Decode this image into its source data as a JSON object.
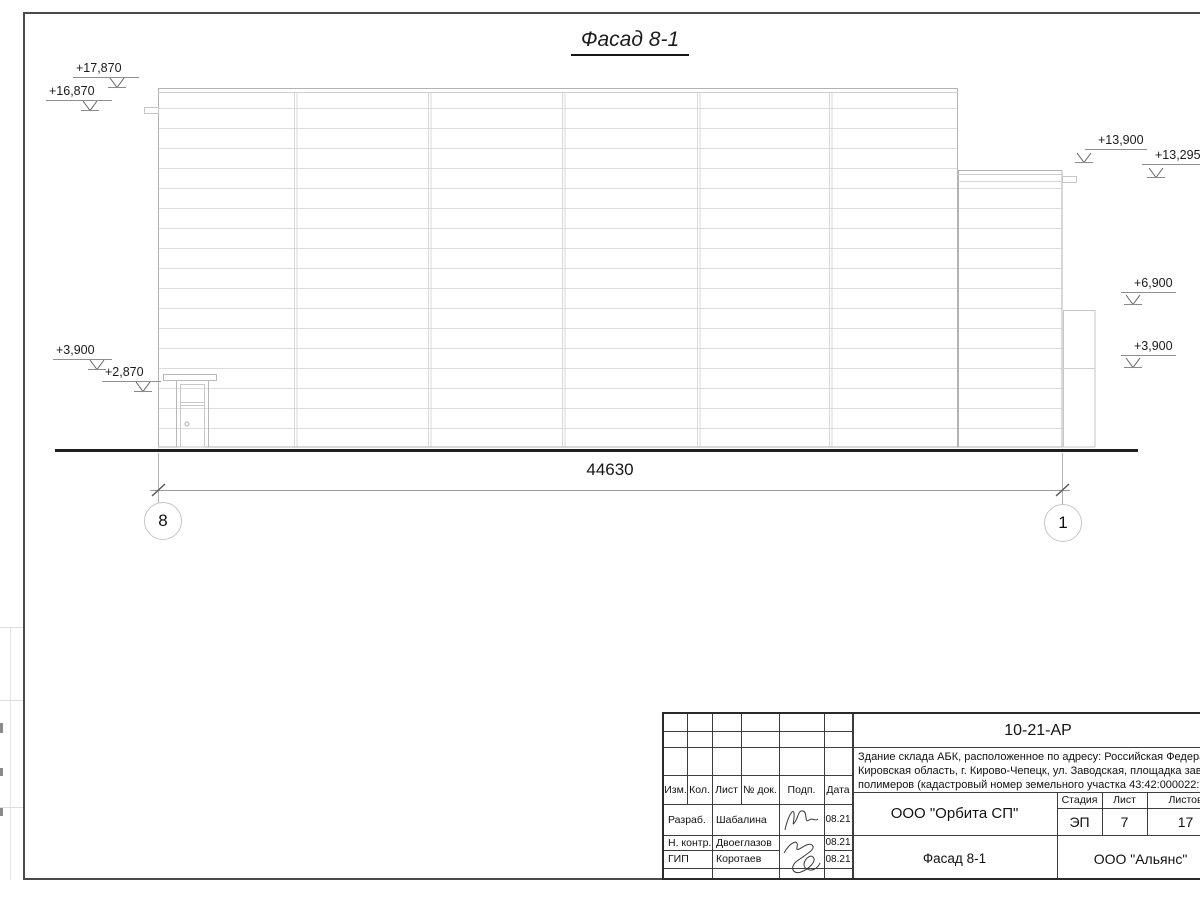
{
  "drawing": {
    "title": "Фасад 8-1",
    "total_dimension": "44630",
    "axis_left": "8",
    "axis_right": "1",
    "elevations": {
      "top_left_1": "+17,870",
      "top_left_2": "+16,870",
      "right_1": "+13,900",
      "right_2": "+13,295",
      "right_3": "+6,900",
      "right_4": "+3,900",
      "left_1": "+3,900",
      "left_2": "+2,870"
    }
  },
  "title_block": {
    "doc_number": "10-21-АР",
    "description_lines": [
      "Здание склада АБК, расположенное по адресу: Российская Федерац",
      "Кировская область, г. Кирово-Чепецк, ул. Заводская, площадка заво",
      "полимеров (кадастровый номер земельного участка 43:42:000022:"
    ],
    "columns": [
      "Изм.",
      "Кол.",
      "Лист",
      "№ док.",
      "Подп.",
      "Дата"
    ],
    "approvals": [
      {
        "role": "Разраб.",
        "name": "Шабалина",
        "date": "08.21"
      },
      {
        "role": "Н. контр.",
        "name": "Двоеглазов",
        "date": "08.21"
      },
      {
        "role": "ГИП",
        "name": "Коротаев",
        "date": "08.21"
      }
    ],
    "designer_company": "ООО \"Орбита СП\"",
    "sheet_name": "Фасад 8-1",
    "client_company": "ООО \"Альянс\"",
    "stage_label": "Стадия",
    "sheet_label": "Лист",
    "sheets_label": "Листов",
    "stage": "ЭП",
    "sheet_number": "7",
    "sheets_total": "17"
  }
}
